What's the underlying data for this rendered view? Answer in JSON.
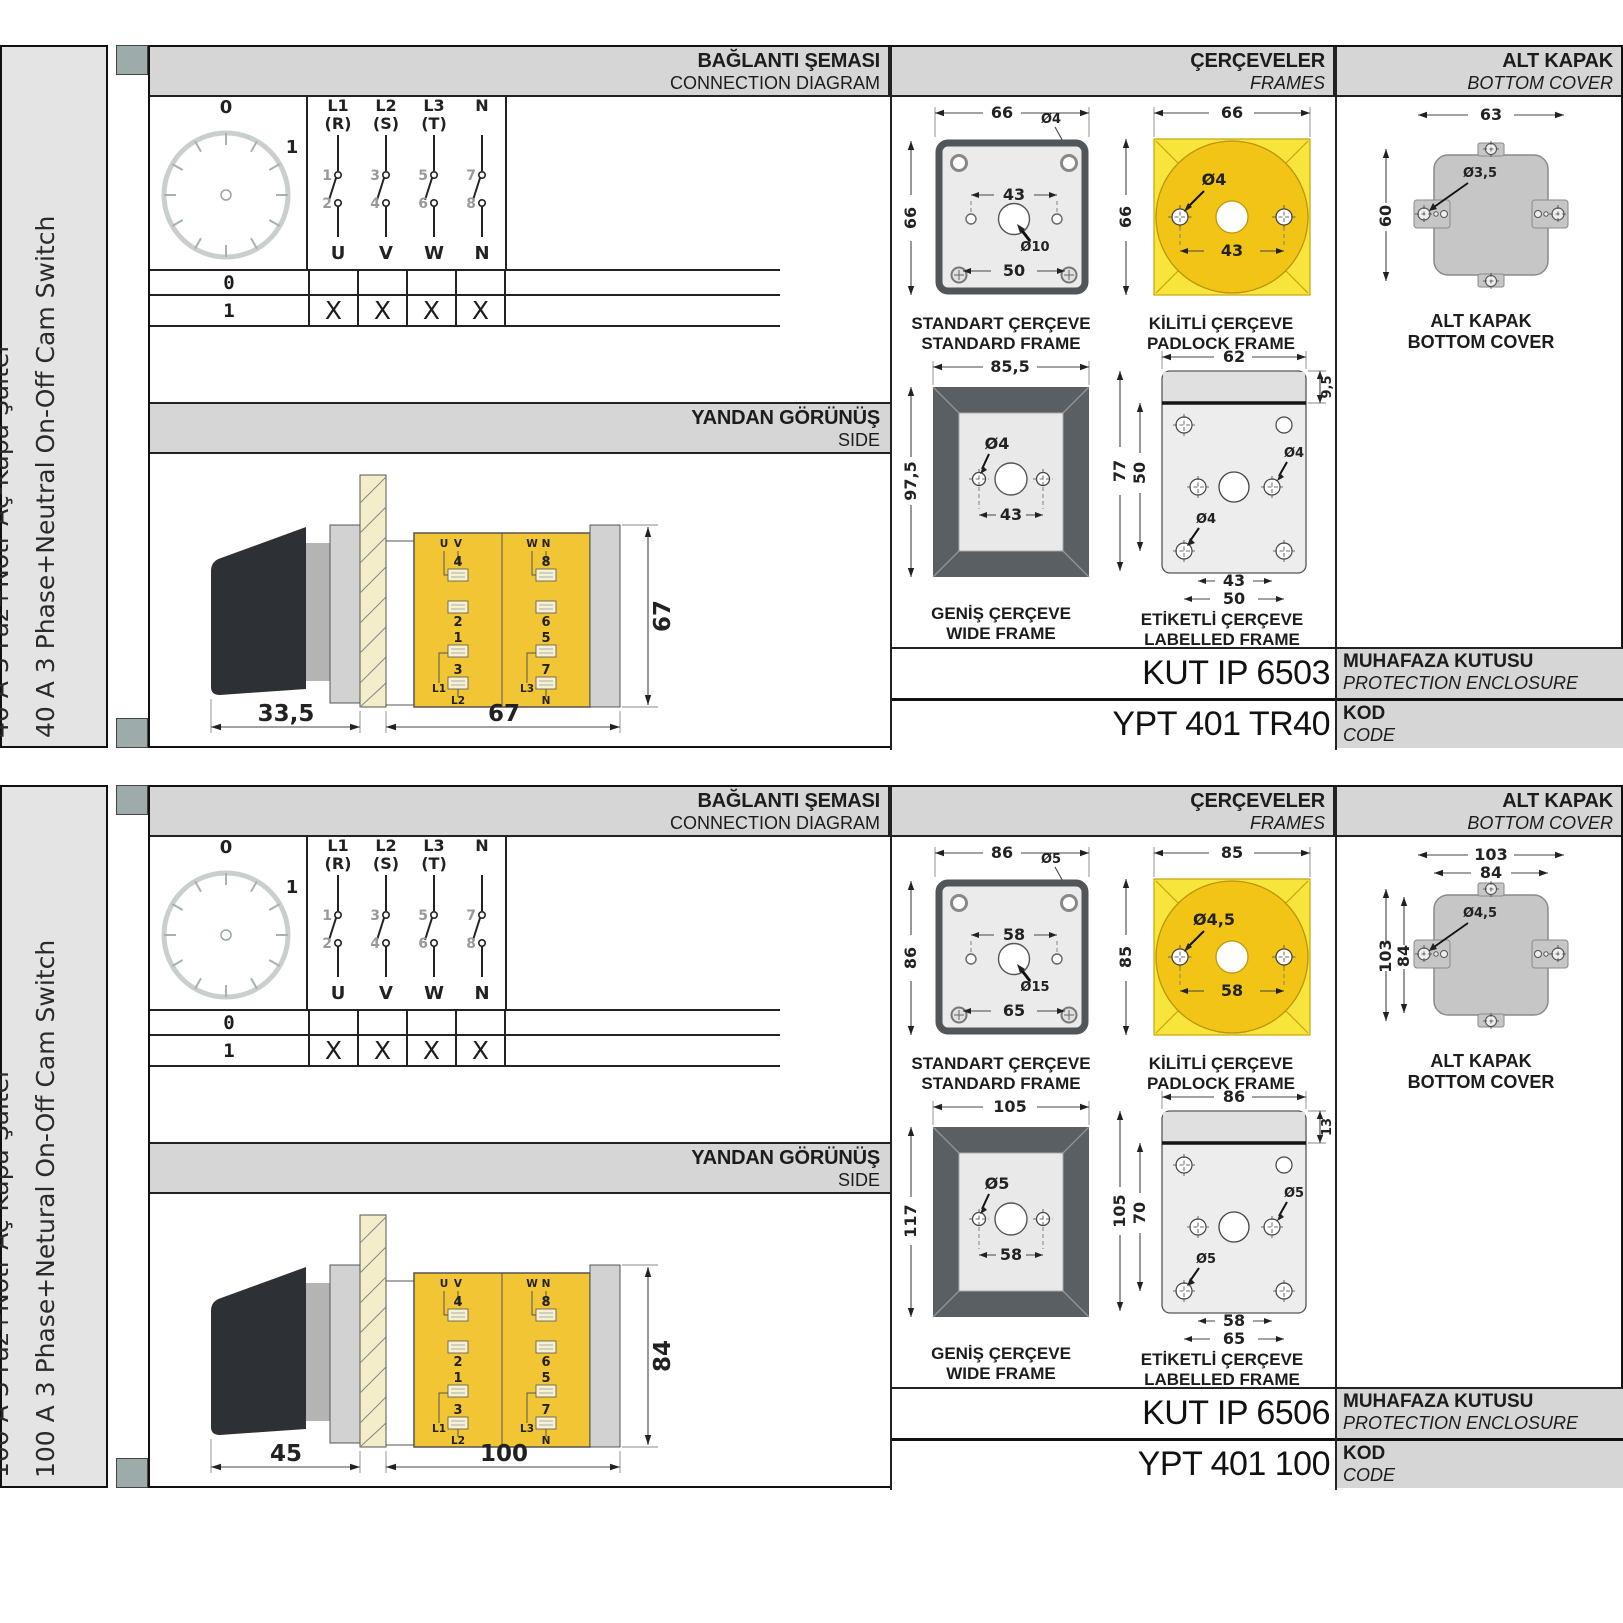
{
  "colors": {
    "panel_gray": "#d6d6d6",
    "sidebar_gray": "#e4e4e4",
    "marker_teal": "#9dabab",
    "frame_yellow": "#f8e53c",
    "frame_yellow_dark": "#f1c416",
    "body_yellow": "#f2c535",
    "frame_dark": "#5a5f63",
    "cover_gray": "#c6c6c6"
  },
  "sections": [
    {
      "side_label_tr": "40 A 3 Faz+Nötr Aç-Kapa Şalter",
      "side_label_en": "40 A 3 Phase+Neutral On-Off Cam Switch",
      "col_headers": {
        "diagram_tr": "BAĞLANTI ŞEMASI",
        "diagram_en": "CONNECTION DIAGRAM",
        "frames_tr": "ÇERÇEVELER",
        "frames_en": "FRAMES",
        "cover_tr": "ALT KAPAK",
        "cover_en": "BOTTOM COVER"
      },
      "dial": {
        "pos0": "0",
        "pos1": "1"
      },
      "switches": {
        "phase1": "L1",
        "phase1_sub": "(R)",
        "phase2": "L2",
        "phase2_sub": "(S)",
        "phase3": "L3",
        "phase3_sub": "(T)",
        "phase4": "N",
        "t1": "1",
        "t2": "2",
        "t3": "3",
        "t4": "4",
        "t5": "5",
        "t6": "6",
        "t7": "7",
        "t8": "8",
        "out1": "U",
        "out2": "V",
        "out3": "W",
        "out4": "N"
      },
      "table": {
        "row0_label": "0",
        "row1_label": "1",
        "row1_marks": [
          "X",
          "X",
          "X",
          "X"
        ]
      },
      "side_view": {
        "title_tr": "YANDAN GÖRÜNÜŞ",
        "title_en": "SIDE",
        "dim_handle": "33,5",
        "dim_depth": "67",
        "dim_height": "67",
        "labels": {
          "u": "U",
          "v": "V",
          "w": "W",
          "n_top": "N",
          "t4": "4",
          "t2": "2",
          "t8": "8",
          "t6": "6",
          "t1": "1",
          "t3": "3",
          "t5": "5",
          "t7": "7",
          "l1": "L1",
          "l2": "L2",
          "l3": "L3",
          "n_bot": "N"
        }
      },
      "frames": {
        "standard": {
          "cap_tr": "STANDART ÇERÇEVE",
          "cap_en": "STANDARD FRAME",
          "w": "66",
          "h": "66",
          "hole": "Ø4",
          "span": "43",
          "center": "Ø10",
          "bottom": "50"
        },
        "padlock": {
          "cap_tr": "KİLİTLİ ÇERÇEVE",
          "cap_en": "PADLOCK FRAME",
          "w": "66",
          "h": "66",
          "hole": "Ø4",
          "span": "43"
        },
        "wide": {
          "cap_tr": "GENİŞ ÇERÇEVE",
          "cap_en": "WIDE FRAME",
          "w": "85,5",
          "h": "97,5",
          "hole": "Ø4",
          "span": "43"
        },
        "labelled": {
          "cap_tr": "ETİKETLİ ÇERÇEVE",
          "cap_en": "LABELLED FRAME",
          "w": "62",
          "strip": "9,5",
          "h": "77",
          "inner": "50",
          "hole_right": "Ø4",
          "hole_left": "Ø4",
          "span": "43",
          "bottom": "50"
        }
      },
      "cover": {
        "cap_tr": "ALT KAPAK",
        "cap_en": "BOTTOM COVER",
        "h1": "63",
        "v1": "60",
        "hole": "Ø3,5"
      },
      "codes": {
        "enclosure_value": "KUT IP 6503",
        "enclosure_tr": "MUHAFAZA KUTUSU",
        "enclosure_en": "PROTECTION ENCLOSURE",
        "code_value": "YPT 401 TR40",
        "code_tr": "KOD",
        "code_en": "CODE"
      }
    },
    {
      "side_label_tr": "100 A 3 Faz+Nötr Aç Kapa Şalter",
      "side_label_en": "100 A 3 Phase+Netural On-Off Cam Switch",
      "col_headers": {
        "diagram_tr": "BAĞLANTI ŞEMASI",
        "diagram_en": "CONNECTION DIAGRAM",
        "frames_tr": "ÇERÇEVELER",
        "frames_en": "FRAMES",
        "cover_tr": "ALT KAPAK",
        "cover_en": "BOTTOM COVER"
      },
      "dial": {
        "pos0": "0",
        "pos1": "1"
      },
      "switches": {
        "phase1": "L1",
        "phase1_sub": "(R)",
        "phase2": "L2",
        "phase2_sub": "(S)",
        "phase3": "L3",
        "phase3_sub": "(T)",
        "phase4": "N",
        "t1": "1",
        "t2": "2",
        "t3": "3",
        "t4": "4",
        "t5": "5",
        "t6": "6",
        "t7": "7",
        "t8": "8",
        "out1": "U",
        "out2": "V",
        "out3": "W",
        "out4": "N"
      },
      "table": {
        "row0_label": "0",
        "row1_label": "1",
        "row1_marks": [
          "X",
          "X",
          "X",
          "X"
        ]
      },
      "side_view": {
        "title_tr": "YANDAN GÖRÜNÜŞ",
        "title_en": "SIDE",
        "dim_handle": "45",
        "dim_depth": "100",
        "dim_height": "84",
        "labels": {
          "u": "U",
          "v": "V",
          "w": "W",
          "n_top": "N",
          "t4": "4",
          "t2": "2",
          "t8": "8",
          "t6": "6",
          "t1": "1",
          "t3": "3",
          "t5": "5",
          "t7": "7",
          "l1": "L1",
          "l2": "L2",
          "l3": "L3",
          "n_bot": "N"
        }
      },
      "frames": {
        "standard": {
          "cap_tr": "STANDART ÇERÇEVE",
          "cap_en": "STANDARD FRAME",
          "w": "86",
          "h": "86",
          "hole": "Ø5",
          "span": "58",
          "center": "Ø15",
          "bottom": "65"
        },
        "padlock": {
          "cap_tr": "KİLİTLİ ÇERÇEVE",
          "cap_en": "PADLOCK FRAME",
          "w": "85",
          "h": "85",
          "hole": "Ø4,5",
          "span": "58"
        },
        "wide": {
          "cap_tr": "GENİŞ ÇERÇEVE",
          "cap_en": "WIDE FRAME",
          "w": "105",
          "h": "117",
          "hole": "Ø5",
          "span": "58"
        },
        "labelled": {
          "cap_tr": "ETİKETLİ ÇERÇEVE",
          "cap_en": "LABELLED FRAME",
          "w": "86",
          "strip": "13",
          "h": "105",
          "inner": "70",
          "hole_right": "Ø5",
          "hole_left": "Ø5",
          "span": "58",
          "bottom": "65"
        }
      },
      "cover": {
        "cap_tr": "ALT KAPAK",
        "cap_en": "BOTTOM COVER",
        "h1": "103",
        "h2": "84",
        "v1": "103",
        "v2": "84",
        "hole": "Ø4,5"
      },
      "codes": {
        "enclosure_value": "KUT IP 6506",
        "enclosure_tr": "MUHAFAZA KUTUSU",
        "enclosure_en": "PROTECTION ENCLOSURE",
        "code_value": "YPT 401 100",
        "code_tr": "KOD",
        "code_en": "CODE"
      }
    }
  ]
}
